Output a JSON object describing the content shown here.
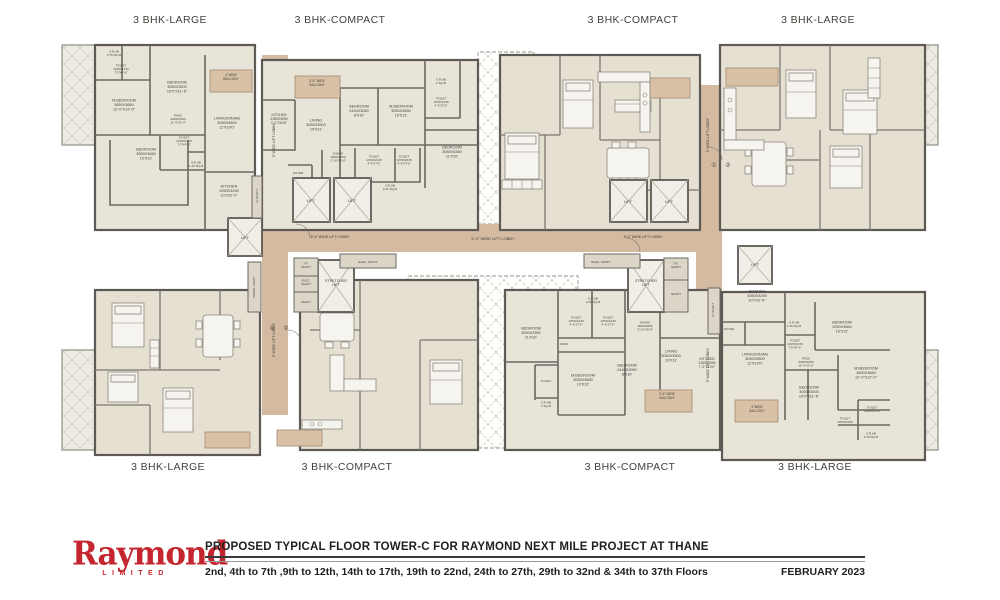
{
  "colors": {
    "room": "#e9e4d8",
    "room_furnished": "#e6e0d2",
    "corridor": "#d3baa0",
    "balcony": "#d8c1a6",
    "wall": "#5d5a55",
    "label": "#44413c",
    "brand_red": "#c5252e",
    "footer_text": "#1f1f1f"
  },
  "unit_labels_top": [
    {
      "label": "3 BHK-LARGE",
      "x": 170
    },
    {
      "label": "3 BHK-COMPACT",
      "x": 340
    },
    {
      "label": "3 BHK-COMPACT",
      "x": 633
    },
    {
      "label": "3 BHK-LARGE",
      "x": 818
    }
  ],
  "unit_labels_bottom": [
    {
      "label": "3 BHK-LARGE",
      "x": 168
    },
    {
      "label": "3 BHK-COMPACT",
      "x": 347
    },
    {
      "label": "3 BHK-COMPACT",
      "x": 630
    },
    {
      "label": "3 BHK-LARGE",
      "x": 815
    }
  ],
  "footer": {
    "brand": "Raymond",
    "brand_sub": "LIMITED",
    "title": "PROPOSED TYPICAL FLOOR TOWER-C FOR RAYMOND NEXT MILE PROJECT AT THANE",
    "floors": "2nd, 4th to 7th ,9th to 12th, 14th to 17th, 19th to 22nd, 24th to 27th, 29th to 32nd & 34th to 37th Floors",
    "date": "FEBRUARY 2023"
  },
  "plan": {
    "labels": [
      {
        "t": "LIFT",
        "x": 311,
        "y": 202,
        "s": 4
      },
      {
        "t": "LIFT",
        "x": 352,
        "y": 202,
        "s": 4
      },
      {
        "t": "LIFT",
        "x": 628,
        "y": 203,
        "s": 4
      },
      {
        "t": "LIFT",
        "x": 669,
        "y": 203,
        "s": 4
      },
      {
        "t": "LIFT",
        "x": 245,
        "y": 239,
        "s": 4
      },
      {
        "t": "LIFT",
        "x": 755,
        "y": 266,
        "s": 4
      },
      {
        "t": "8'-9\" WIDE LIFT LOBBY",
        "x": 330,
        "y": 238,
        "s": 3.6
      },
      {
        "t": "8'-9\" WIDE LIFT LOBBY",
        "x": 643,
        "y": 238,
        "s": 3.6
      },
      {
        "t": "5'-9\" WIDE LIFT LOBBY",
        "x": 493,
        "y": 240,
        "s": 4
      },
      {
        "t": "5' WIDE LIFT LOBBY",
        "x": 275,
        "y": 140,
        "s": 3.6,
        "r": -90
      },
      {
        "t": "5' WIDE LIFT LOBBY",
        "x": 275,
        "y": 340,
        "s": 3.6,
        "r": -90
      },
      {
        "t": "5' WIDE LIFT LOBBY",
        "x": 709,
        "y": 135,
        "s": 3.6,
        "r": -90
      },
      {
        "t": "5' WIDE LIFT LOBBY",
        "x": 709,
        "y": 365,
        "s": 3.6,
        "r": -90
      },
      {
        "t": "STRETCHER\nLIFT",
        "x": 336,
        "y": 284,
        "s": 3.6
      },
      {
        "t": "STRETCHER\nLIFT",
        "x": 646,
        "y": 284,
        "s": 3.6
      },
      {
        "t": "F.F.\nSHAFT",
        "x": 306,
        "y": 266,
        "s": 3
      },
      {
        "t": "ELEC.\nSHAFT",
        "x": 306,
        "y": 283,
        "s": 3
      },
      {
        "t": "SHAFT",
        "x": 306,
        "y": 303,
        "s": 3
      },
      {
        "t": "PRESS. SHAFT",
        "x": 255,
        "y": 287,
        "s": 3,
        "r": -90
      },
      {
        "t": "LV SHAFT",
        "x": 258,
        "y": 196,
        "s": 3,
        "r": -90
      },
      {
        "t": "ELEC. SHAFT",
        "x": 368,
        "y": 263,
        "s": 3
      },
      {
        "t": "ELEC. SHAFT",
        "x": 601,
        "y": 263,
        "s": 3
      },
      {
        "t": "F.F.\nSHAFT",
        "x": 676,
        "y": 266,
        "s": 3
      },
      {
        "t": "SHAFT",
        "x": 676,
        "y": 295,
        "s": 3
      },
      {
        "t": "LV SHAFT",
        "x": 714,
        "y": 310,
        "s": 3,
        "r": -90
      },
      {
        "t": "①",
        "x": 272,
        "y": 330,
        "s": 6
      },
      {
        "t": "②",
        "x": 286,
        "y": 330,
        "s": 6
      },
      {
        "t": "①",
        "x": 714,
        "y": 167,
        "s": 6
      },
      {
        "t": "②",
        "x": 728,
        "y": 167,
        "s": 6
      },
      {
        "t": "S.R.AB\n0.79 SQ.M",
        "x": 114,
        "y": 54,
        "s": 3
      },
      {
        "t": "TOILET\n2135X1370\n7'0\"X4'-6\"",
        "x": 121,
        "y": 70,
        "s": 3
      },
      {
        "t": "BEDROOM\n3050X3500\n10'0\"X11'-6\"",
        "x": 177,
        "y": 88,
        "s": 3.8
      },
      {
        "t": "M.BEDROOM\n3650X3660\n12'-0\"X12'-0\"",
        "x": 124,
        "y": 106,
        "s": 3.8
      },
      {
        "t": "PASS\n3460X1000\n11'-4\"X3'-3\"",
        "x": 178,
        "y": 120,
        "s": 3
      },
      {
        "t": "LIVING/DINING\n3050X5800\n11'X19'0\"",
        "x": 227,
        "y": 124,
        "s": 3.8
      },
      {
        "t": "TOILET\n2135X1370\n7'0\"X4'-6\"",
        "x": 184,
        "y": 142,
        "s": 3
      },
      {
        "t": "BEDROOM\n3050X3660\n10'X12'",
        "x": 146,
        "y": 155,
        "s": 3.8
      },
      {
        "t": "S.R.AB\n1.40 SQ.M",
        "x": 196,
        "y": 165,
        "s": 3
      },
      {
        "t": "KITCHEN\n3050X3290\n10'X10'-9\"",
        "x": 229,
        "y": 192,
        "s": 3.8
      },
      {
        "t": "4' WIDE\nBALCONY",
        "x": 231,
        "y": 78,
        "s": 3.2
      },
      {
        "t": "KITCHEN\n2180X3050\n7'-2\"X10'0\"",
        "x": 279,
        "y": 120,
        "s": 3.4
      },
      {
        "t": "3'-6\" WIDE\nBALCONY",
        "x": 317,
        "y": 84,
        "s": 3.2
      },
      {
        "t": "LIVING\n3050X3500\n10'X11'",
        "x": 316,
        "y": 126,
        "s": 3.8
      },
      {
        "t": "BEDROOM\n2440X3050\n8'X10'",
        "x": 359,
        "y": 112,
        "s": 3.8
      },
      {
        "t": "M.BEDROOM\n3050X3650\n10'X12'",
        "x": 401,
        "y": 112,
        "s": 3.8
      },
      {
        "t": "S.R.AB\n1 SQ.M",
        "x": 441,
        "y": 82,
        "s": 3
      },
      {
        "t": "TOILET\n1370X2135\n4'-6\"X7'0\"",
        "x": 441,
        "y": 103,
        "s": 3
      },
      {
        "t": "BEDROOM\n3050X3350\n11'X10'",
        "x": 452,
        "y": 153,
        "s": 3.8
      },
      {
        "t": "DINING\n1180X2650\n3'-10\"X8'-8\"",
        "x": 338,
        "y": 158,
        "s": 3
      },
      {
        "t": "TOILET\n1370X2135\n4'-6\"X7'0\"",
        "x": 374,
        "y": 161,
        "s": 3
      },
      {
        "t": "TOILET\n1370X2135\n4'-6\"X7'0\"",
        "x": 404,
        "y": 161,
        "s": 3
      },
      {
        "t": "FOYER",
        "x": 298,
        "y": 174,
        "s": 3
      },
      {
        "t": "S.R.AB\n2.21 SQ.M",
        "x": 390,
        "y": 188,
        "s": 3
      },
      {
        "t": "S.R.AB\n2.21 SQ.M",
        "x": 593,
        "y": 301,
        "s": 3
      },
      {
        "t": "BEDROOM\n3050X3350\n11'X10'",
        "x": 531,
        "y": 334,
        "s": 3.8
      },
      {
        "t": "TOILET\n1370X2135\n4'-6\"X7'0\"",
        "x": 576,
        "y": 322,
        "s": 3
      },
      {
        "t": "TOILET\n1370X2135\n4'-6\"X7'0\"",
        "x": 608,
        "y": 322,
        "s": 3
      },
      {
        "t": "DINING\n1180X2650\n3'-10\"X8'-8\"",
        "x": 645,
        "y": 327,
        "s": 3
      },
      {
        "t": "PASS",
        "x": 564,
        "y": 345,
        "s": 3
      },
      {
        "t": "TOILET",
        "x": 546,
        "y": 382,
        "s": 3
      },
      {
        "t": "M.BEDROOM\n3050X3650\n10'X12'",
        "x": 583,
        "y": 381,
        "s": 3.8
      },
      {
        "t": "BEDROOM\n2440X3050\n8'X10'",
        "x": 627,
        "y": 371,
        "s": 3.8
      },
      {
        "t": "LIVING\n3050X3500\n10'X11'",
        "x": 671,
        "y": 357,
        "s": 3.8
      },
      {
        "t": "KITCHEN\n2180X3050\n7'-2\"X10'0\"",
        "x": 707,
        "y": 364,
        "s": 3.4
      },
      {
        "t": "S.R.AB\n1 SQ.M",
        "x": 546,
        "y": 405,
        "s": 3
      },
      {
        "t": "3'-6\" WIDE\nBALCONY",
        "x": 667,
        "y": 397,
        "s": 3.2
      },
      {
        "t": "KITCHEN\n3050X3290\n10'X10'-9\"",
        "x": 757,
        "y": 297,
        "s": 3.8
      },
      {
        "t": "FOYER",
        "x": 729,
        "y": 330,
        "s": 3
      },
      {
        "t": "S.R.AB\n1.40 SQ.M",
        "x": 794,
        "y": 325,
        "s": 3
      },
      {
        "t": "BEDROOM\n3050X3660\n10'X12'",
        "x": 842,
        "y": 328,
        "s": 3.8
      },
      {
        "t": "TOILET\n2135X1370\n7'0\"X4'-6\"",
        "x": 795,
        "y": 345,
        "s": 3
      },
      {
        "t": "LIVING/DINING\n3050X5800\n11'X19'0\"",
        "x": 755,
        "y": 360,
        "s": 3.8
      },
      {
        "t": "PASS\n3460X1000\n11'-4\"X3'-3\"",
        "x": 806,
        "y": 363,
        "s": 3
      },
      {
        "t": "M.BEDROOM\n3650X3660\n12'-0\"X12'-0\"",
        "x": 866,
        "y": 374,
        "s": 3.8
      },
      {
        "t": "BEDROOM\n3050X3500\n10'0\"X11'-6\"",
        "x": 809,
        "y": 393,
        "s": 3.8
      },
      {
        "t": "TOILET\n1370X2135",
        "x": 845,
        "y": 421,
        "s": 3
      },
      {
        "t": "TOILET\n2135X1370",
        "x": 872,
        "y": 410,
        "s": 3
      },
      {
        "t": "S.R.AB\n0.79 SQ.M",
        "x": 871,
        "y": 436,
        "s": 3
      },
      {
        "t": "4' WIDE\nBALCONY",
        "x": 757,
        "y": 410,
        "s": 3.2
      }
    ]
  }
}
